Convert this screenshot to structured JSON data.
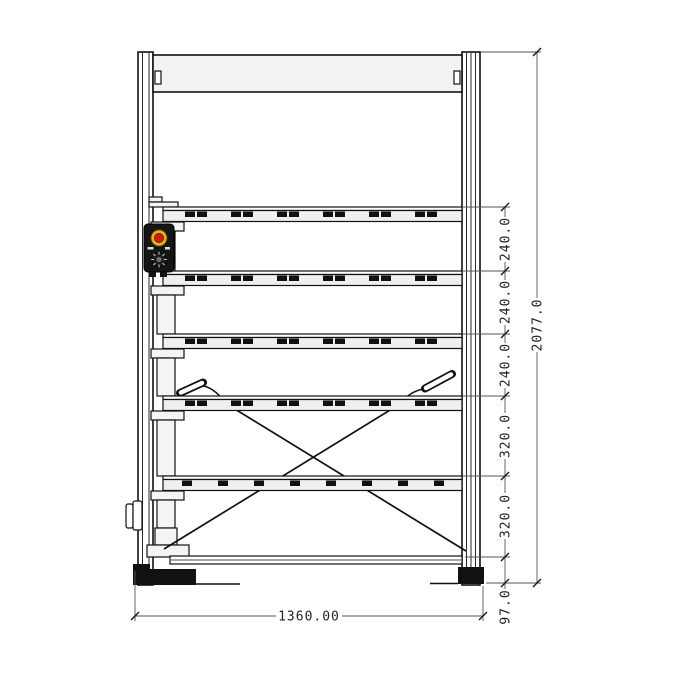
{
  "drawing": {
    "type": "engineering-drawing-front-elevation",
    "subject": "five-level roller storage rack with lift mast, emergency-stop control box, diagonal tension braces and floor feet",
    "units_hint": "mm"
  },
  "dimensions": {
    "overall_height": "2077.0",
    "overall_width": "1360.00",
    "right_chain": [
      "240.0",
      "240.0",
      "240.0",
      "320.0",
      "320.0",
      "97.0"
    ]
  },
  "colors": {
    "line": "#1a1a1a",
    "dim_line": "#555555",
    "panel_fill": "#f2f2f2",
    "estop_red": "#cf1c10",
    "estop_yellow": "#e9b400"
  },
  "icons": {
    "estop_button": "emergency-stop-button",
    "selector_knob": "rotary-selector-knob"
  }
}
